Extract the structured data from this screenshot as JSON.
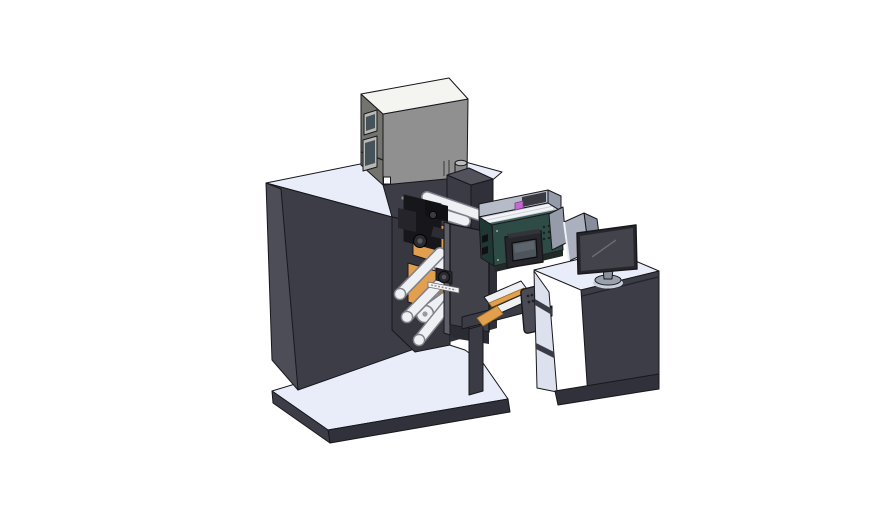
{
  "canvas": {
    "width": 888,
    "height": 522,
    "background": "#ffffff"
  },
  "scene": {
    "kind": "3d-cad-render",
    "subject": "label-printing-and-inspection-machine-with-operator-desk",
    "components": [
      {
        "id": "printer-unit",
        "color_key": "printer_front"
      },
      {
        "id": "main-cabinet",
        "color_key": "cabinet_front"
      },
      {
        "id": "print-mechanism",
        "color_key": "black_part"
      },
      {
        "id": "unwind-spool-upper",
        "color_key": "orange"
      },
      {
        "id": "unwind-spool-lower",
        "color_key": "orange"
      },
      {
        "id": "guide-rollers",
        "color_key": "roller_fill"
      },
      {
        "id": "side-plate",
        "color_key": "plate"
      },
      {
        "id": "inspection-module",
        "color_key": "teal_front"
      },
      {
        "id": "hmi-panel",
        "color_key": "screen_bezel"
      },
      {
        "id": "shield-panels",
        "color_key": "shield_light"
      },
      {
        "id": "conveyor-ramp",
        "color_key": "orange"
      },
      {
        "id": "pendant-control",
        "color_key": "gray_part"
      },
      {
        "id": "support-stand",
        "color_key": "cabinet_front"
      },
      {
        "id": "operator-desk",
        "color_key": "cabinet_front"
      },
      {
        "id": "monitor",
        "color_key": "screen_fill"
      },
      {
        "id": "machine-base-plate",
        "color_key": "surface_top"
      },
      {
        "id": "desk-base-plate",
        "color_key": "surface_top"
      }
    ]
  },
  "palette": {
    "background": "#ffffff",
    "outline": "#17171c",
    "surface_top": "#e9edf9",
    "cabinet_front": "#3d3d47",
    "cabinet_side": "#4d4d57",
    "cabinet_dark": "#31313b",
    "bay_dark": "#37373f",
    "bay_darker": "#2f2f38",
    "plate": "#41414a",
    "plate_edge": "#5e5e68",
    "printer_front": "#909090",
    "printer_side": "#74746f",
    "printer_top": "#f4f4f1",
    "window_frame": "#b8b8b4",
    "window_glass": "#46525a",
    "teal_front": "#2e4b45",
    "teal_side": "#1f3833",
    "teal_rim": "#3f5f58",
    "interior_wall": "#b6bcc7",
    "interior_floor": "#ccd1db",
    "roller_fill": "#eef0f3",
    "roller_edge": "#80808a",
    "orange": "#e2a04f",
    "orange_dark": "#b27c33",
    "black_part": "#17171b",
    "gray_part": "#4b4b55",
    "shield_light": "#aab0be",
    "shield_mid": "#959ba9",
    "shield_dark": "#878d9b",
    "screen_bezel": "#26262c",
    "screen_fill": "#43434c",
    "monitor_base": "#9aa0ac",
    "monitor_stem": "#8a909c",
    "hmi_screen": "#4e545c",
    "purple": "#c468d2",
    "label_white": "#f5f5f5",
    "raised_top": "#52525c",
    "raised_front": "#3b3b45",
    "raised_side": "#30303a",
    "compartment": "#dde1ed"
  }
}
